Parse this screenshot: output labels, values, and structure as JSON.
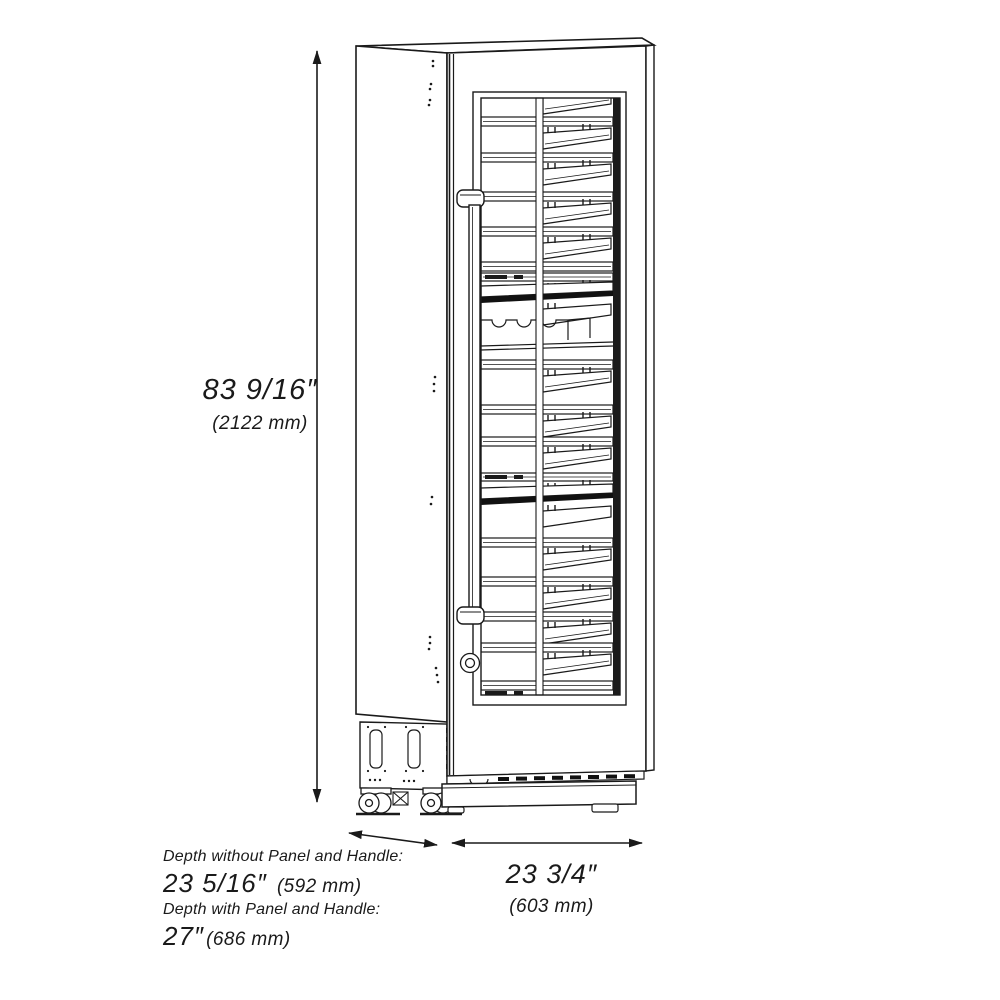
{
  "figure": {
    "type": "technical line drawing",
    "subject": "tall built-in column wine cooler, three-quarter view showing glass door and interior wine racks",
    "line_color": "#1a1a1a",
    "background": "#ffffff"
  },
  "dimensions": {
    "height": {
      "imperial": "83 9/16″",
      "metric": "(2122 mm)"
    },
    "width": {
      "imperial": "23 3/4″",
      "metric": "(603 mm)"
    },
    "depth_without_panel": {
      "label": "Depth without Panel and Handle:",
      "imperial": "23 5/16″",
      "metric": "(592 mm)"
    },
    "depth_with_panel": {
      "label": "Depth with Panel and Handle:",
      "imperial": "27″",
      "metric": "(686 mm)"
    }
  },
  "drawing": {
    "stroke": "#1a1a1a",
    "rows": [
      {
        "y": 117,
        "type": "shelf"
      },
      {
        "y": 153,
        "type": "shelf"
      },
      {
        "y": 192,
        "type": "shelf"
      },
      {
        "y": 227,
        "type": "shelf"
      },
      {
        "y": 262,
        "type": "shelf",
        "tray": false
      },
      {
        "y": 273,
        "type": "led"
      },
      {
        "y": 284,
        "type": "display"
      },
      {
        "y": 316,
        "type": "scallop"
      },
      {
        "y": 360,
        "type": "shelf"
      },
      {
        "y": 405,
        "type": "shelf"
      },
      {
        "y": 437,
        "type": "shelf"
      },
      {
        "y": 473,
        "type": "led"
      },
      {
        "y": 486,
        "type": "display"
      },
      {
        "y": 538,
        "type": "shelf"
      },
      {
        "y": 577,
        "type": "shelf"
      },
      {
        "y": 612,
        "type": "shelf"
      },
      {
        "y": 643,
        "type": "shelf"
      },
      {
        "y": 681,
        "type": "rail_led"
      }
    ]
  }
}
